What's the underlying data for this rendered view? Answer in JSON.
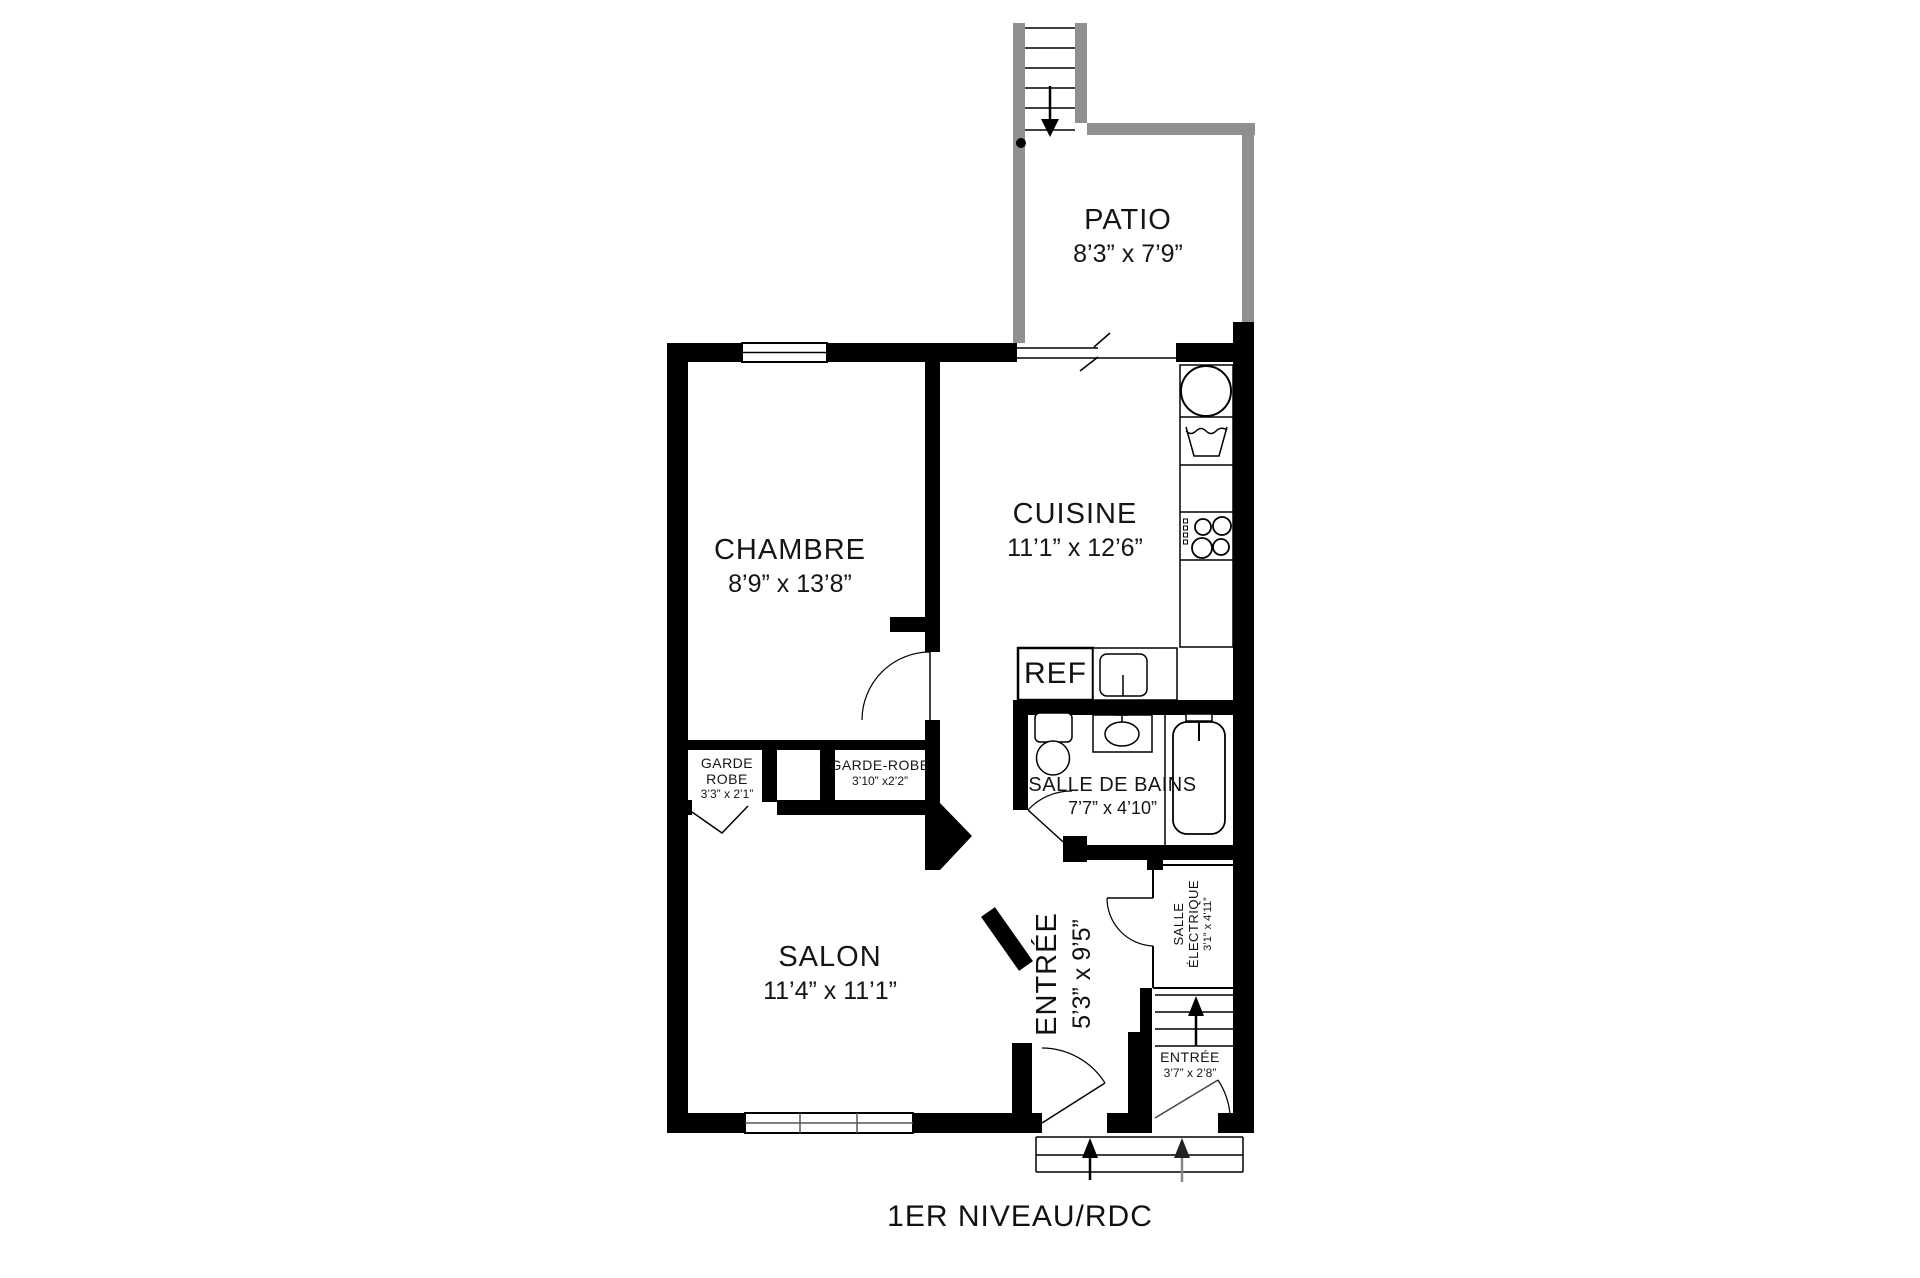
{
  "plan": {
    "title": "1ER NIVEAU/RDC",
    "colors": {
      "interior_wall": "#000000",
      "patio_wall": "#8f8f8f",
      "background": "#ffffff"
    },
    "symbols": {
      "patio_stairs_arrow": "down-arrow",
      "interior_stairs_arrow": "up-arrow",
      "entry_steps_arrows": "up-arrow"
    },
    "rooms": {
      "patio": {
        "name": "PATIO",
        "dims": "8’3” x 7’9”"
      },
      "chambre": {
        "name": "CHAMBRE",
        "dims": "8’9” x 13’8”"
      },
      "cuisine": {
        "name": "CUISINE",
        "dims": "11’1” x 12’6”"
      },
      "salon": {
        "name": "SALON",
        "dims": "11’4” x 11’1”"
      },
      "salle_de_bains": {
        "name": "SALLE DE BAINS",
        "dims": "7’7” x 4’10”"
      },
      "garde_robe_1": {
        "name_line1": "GARDE",
        "name_line2": "ROBE",
        "dims": "3’3” x 2’1”"
      },
      "garde_robe_2": {
        "name": "GARDE-ROBE",
        "dims": "3’10” x2’2”"
      },
      "entree_hall": {
        "name": "ENTRÉE",
        "dims": "5’3” x 9’5”"
      },
      "salle_electrique": {
        "name_line1": "SALLE",
        "name_line2": "ÉLECTRIQUE",
        "dims": "3’1” x 4’11”"
      },
      "entree_vestibule": {
        "name": "ENTRÉE",
        "dims": "3’7” x 2’8”"
      },
      "refrigerator": {
        "label": "REF"
      }
    }
  }
}
